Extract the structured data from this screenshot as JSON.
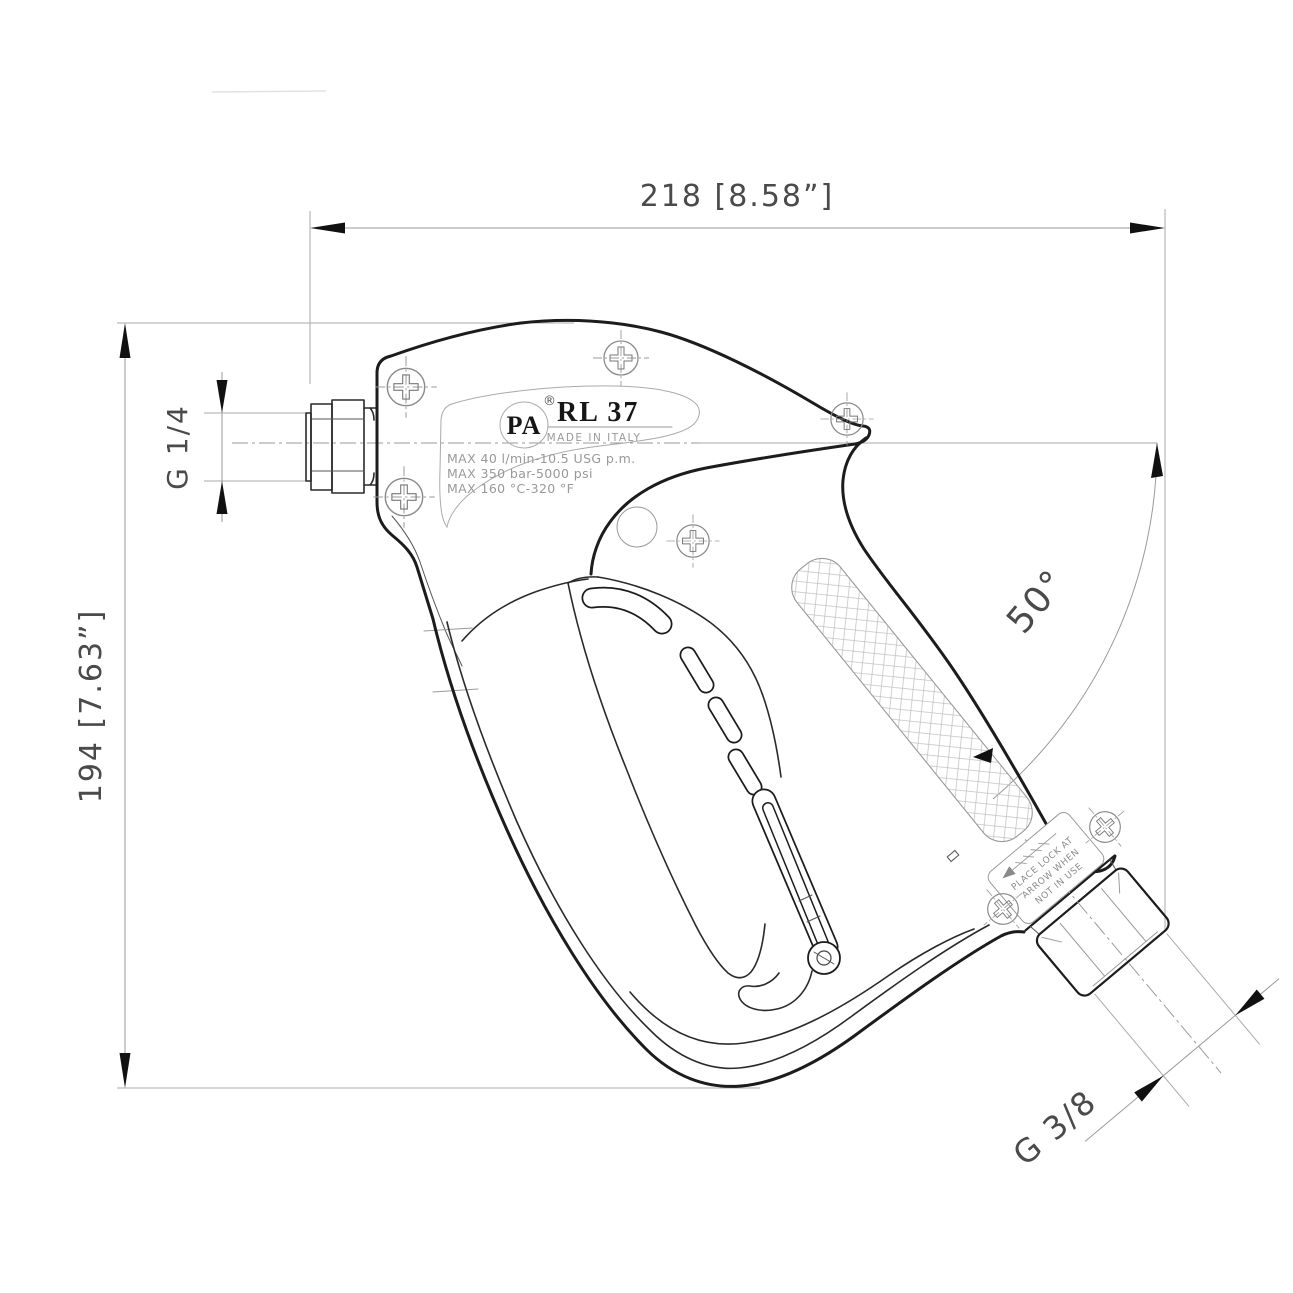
{
  "drawing_title": "PA RL 37 high-pressure spray gun - dimensional technical drawing",
  "annotations": {
    "width_dim": "218 [8.58”]",
    "height_dim": "194 [7.63”]",
    "inlet_thread": "G 1/4",
    "outlet_thread": "G 3/8",
    "outlet_angle": "50°"
  },
  "nameplate": {
    "brand": "PA",
    "registered": "®",
    "model": "RL 37",
    "made_in": "MADE IN ITALY",
    "spec_line1": "MAX 40 l/min-10.5 USG p.m.",
    "spec_line2": "MAX 350 bar-5000 psi",
    "spec_line3": "MAX 160 °C-320 °F"
  },
  "safety_label": {
    "line1": "PLACE LOCK AT",
    "line2": "ARROW WHEN",
    "line3": "NOT IN USE"
  },
  "colors": {
    "background": "#ffffff",
    "outline": "#1c1c1c",
    "annotation_line": "#9a9a9a",
    "annotation_text": "#4a4a4a",
    "light_detail": "#999999"
  }
}
